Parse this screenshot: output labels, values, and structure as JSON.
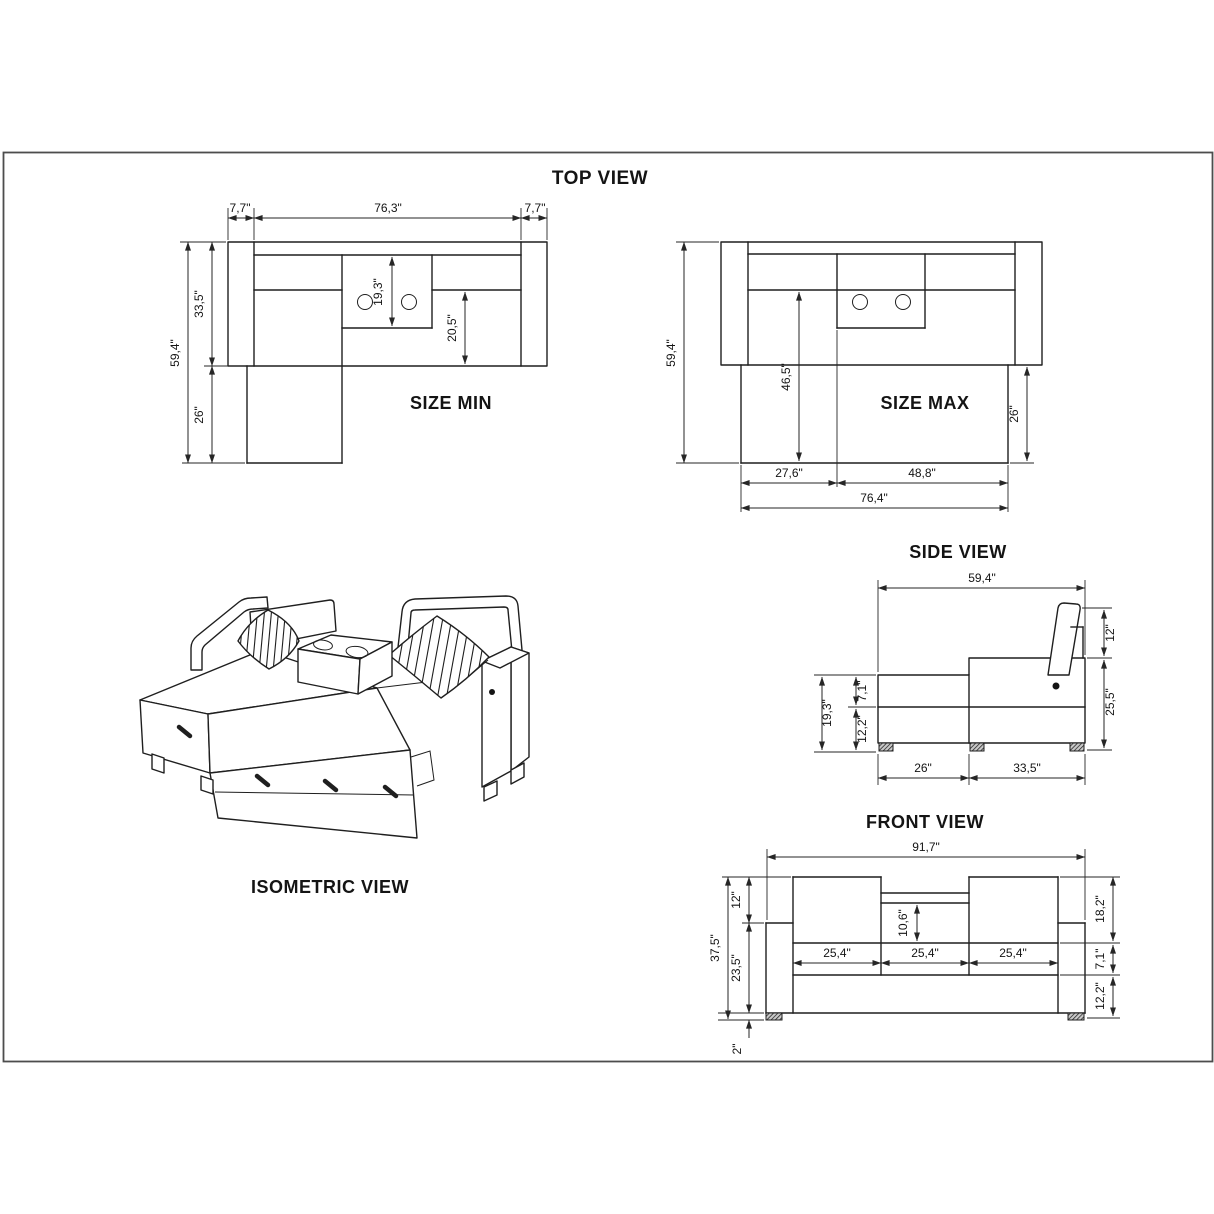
{
  "drawing": {
    "top_view": {
      "title": "TOP VIEW"
    },
    "size_min": {
      "label": "SIZE MIN",
      "arm_width_left": "7,7\"",
      "inner_width": "76,3\"",
      "arm_width_right": "7,7\"",
      "total_depth": "59,4\"",
      "body_depth": "33,5\"",
      "chaise_extension": "26\"",
      "console_depth": "19,3\"",
      "seat_depth": "20,5\""
    },
    "size_max": {
      "label": "SIZE MAX",
      "total_depth": "59,4\"",
      "bed_depth": "46,5\"",
      "bed_extension": "26\"",
      "section_width_left": "27,6\"",
      "section_width_right": "48,8\"",
      "bed_width": "76,4\""
    },
    "side_view": {
      "title": "SIDE VIEW",
      "total_depth": "59,4\"",
      "backrest_height": "12\"",
      "seat_back_height": "25,5\"",
      "chaise_height": "19,3\"",
      "cushion_height": "7,1\"",
      "base_height": "12,2\"",
      "chaise_depth": "26\"",
      "seat_depth": "33,5\""
    },
    "front_view": {
      "title": "FRONT VIEW",
      "total_width": "91,7\"",
      "total_height": "37,5\"",
      "backrest_height": "12\"",
      "arm_height": "23,5\"",
      "leg_height": "2\"",
      "console_drop": "10,6\"",
      "seat_width_left": "25,4\"",
      "seat_width_center": "25,4\"",
      "seat_width_right": "25,4\"",
      "back_total_height": "18,2\"",
      "cushion_height": "7,1\"",
      "base_height": "12,2\""
    },
    "isometric_view": {
      "title": "ISOMETRIC VIEW"
    }
  }
}
